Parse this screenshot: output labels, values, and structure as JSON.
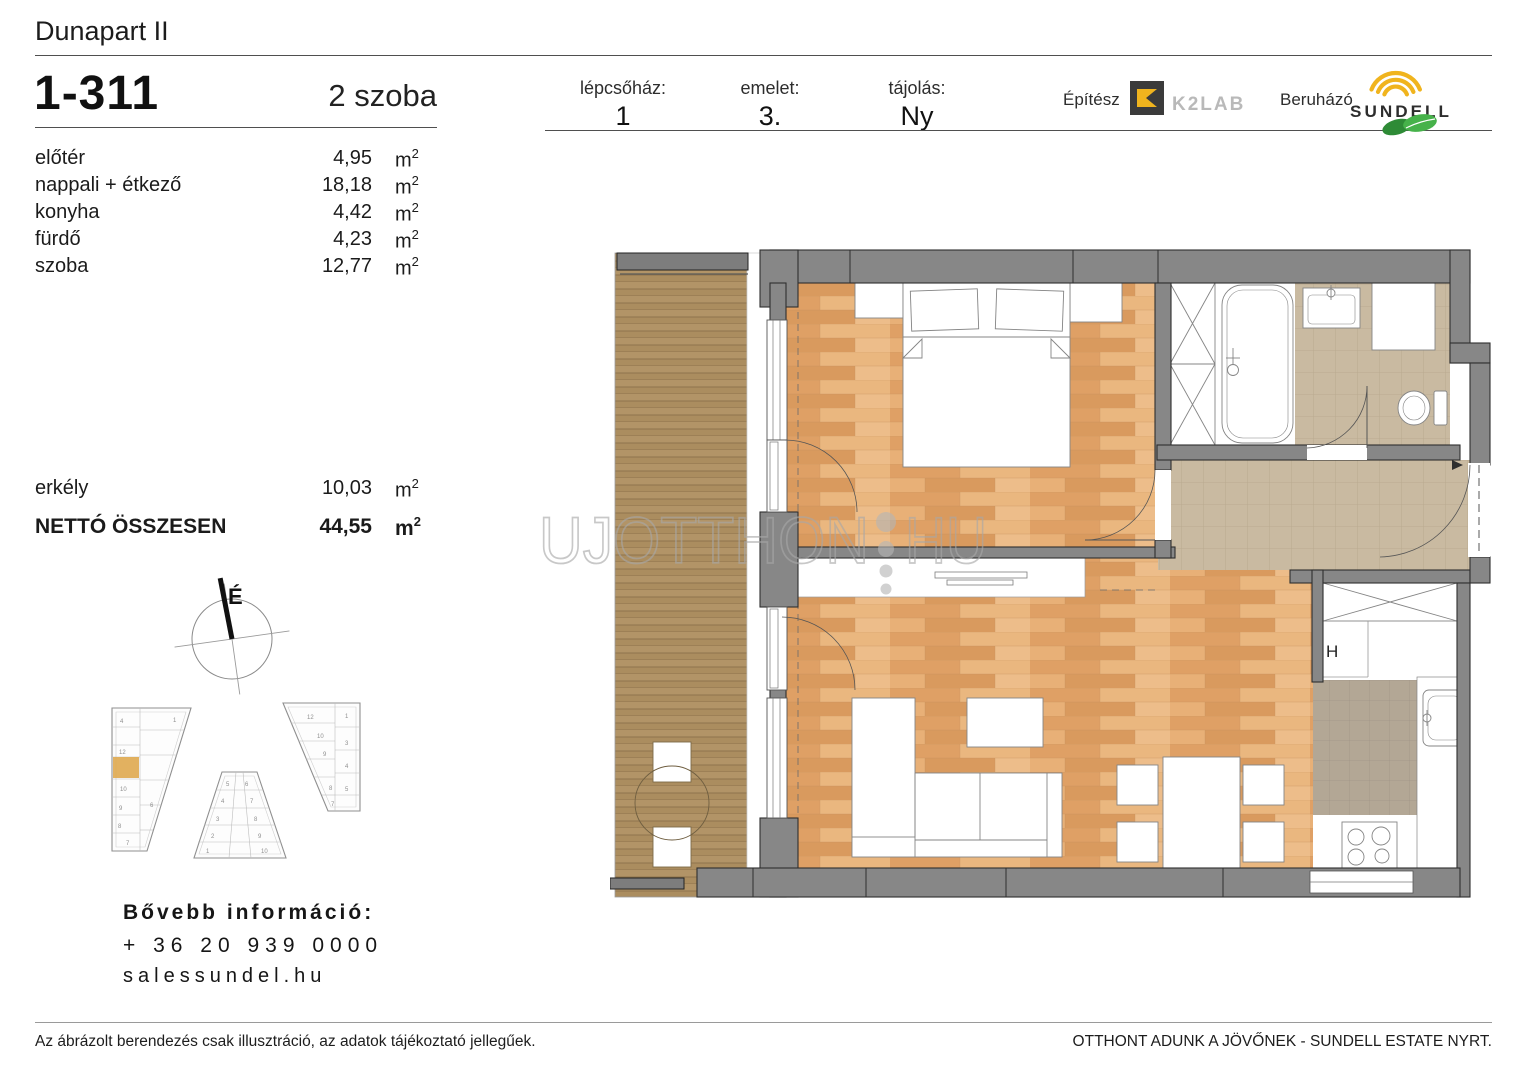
{
  "document": {
    "project_title": "Dunapart II",
    "unit_id": "1-311",
    "unit_type": "2 szoba"
  },
  "header_fields": {
    "staircase": {
      "label": "lépcsőház:",
      "value": "1"
    },
    "floor": {
      "label": "emelet:",
      "value": "3."
    },
    "orientation": {
      "label": "tájolás:",
      "value": "Ny"
    }
  },
  "branding": {
    "architect_label": "Építész",
    "architect_name": "K2LAB",
    "developer_label": "Beruházó",
    "developer_name": "SUNDELL"
  },
  "area_unit": {
    "base": "m",
    "sup": "2"
  },
  "rooms": [
    {
      "label": "előtér",
      "value": "4,95"
    },
    {
      "label": "nappali + étkező",
      "value": "18,18"
    },
    {
      "label": "konyha",
      "value": "4,42"
    },
    {
      "label": "fürdő",
      "value": "4,23"
    },
    {
      "label": "szoba",
      "value": "12,77"
    }
  ],
  "summary": {
    "balcony": {
      "label": "erkély",
      "value": "10,03"
    },
    "total": {
      "label": "NETTÓ ÖSSZESEN",
      "value": "44,55"
    }
  },
  "compass": {
    "north_label": "É"
  },
  "floorplan": {
    "fridge_label": "H"
  },
  "watermark": {
    "left": "UJOTTHON",
    "right": "HU"
  },
  "site_plan": {
    "buildings": [
      {
        "name": "left-building",
        "unit_numbers": [
          "4",
          "1",
          "12",
          "10",
          "9",
          "8",
          "6",
          "7"
        ],
        "highlighted_unit": "1-311"
      },
      {
        "name": "middle-building",
        "unit_numbers": [
          "5",
          "6",
          "4",
          "7",
          "3",
          "8",
          "2",
          "9",
          "1",
          "10"
        ]
      },
      {
        "name": "right-building",
        "unit_numbers": [
          "12",
          "1",
          "10",
          "9",
          "3",
          "4",
          "8",
          "5",
          "7"
        ]
      }
    ]
  },
  "contact": {
    "heading": "Bővebb információ:",
    "phone": "+ 36 20 939 0000",
    "website": "salessundel.hu"
  },
  "footer": {
    "disclaimer": "Az ábrázolt berendezés csak illusztráció, az adatok tájékoztató jellegűek.",
    "slogan": "OTTHONT ADUNK A JÖVŐNEK - SUNDELL ESTATE NYRT."
  },
  "colors": {
    "wall": "#878787",
    "wood_floor": "#e4aa72",
    "deck": "#b29467",
    "tile": "#c9baa1",
    "kitchen_tile": "#b3a795",
    "brand_yellow": "#f0b41e",
    "brand_green": "#46b24a",
    "logo_dark": "#3b3b3b",
    "highlight_unit": "#dfa94f"
  }
}
